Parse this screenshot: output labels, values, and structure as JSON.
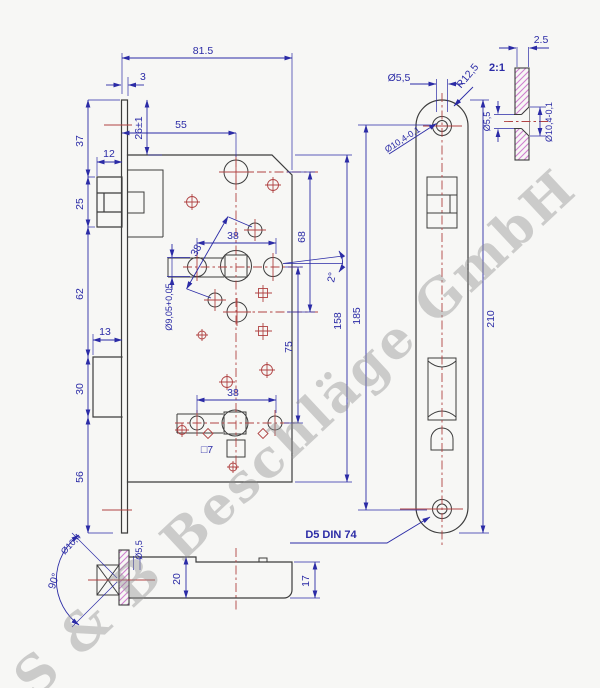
{
  "watermark": "S & B Beschläge GmbH",
  "notes": {
    "din": "D5 DIN 74",
    "detail_scale": "2:1"
  },
  "colors": {
    "outline": "#3c3c3c",
    "dimension": "#2b2ba6",
    "centerline": "#b04343",
    "hatch": "#cf7fcf",
    "watermark": "#8f8f8f"
  },
  "dims": {
    "overall_width": "81.5",
    "faceplate_offset": "3",
    "case_top_offset": "26±1",
    "backset": "55",
    "top_to_latch": "37",
    "latch_depth": "12",
    "latch_height": "25",
    "latch_to_bolt": "62",
    "bolt_depth": "13",
    "bolt_height": "30",
    "bolt_to_bottom": "56",
    "hole_pitch_upper": "38",
    "hole_pitch_diag": "38",
    "hole_pitch_lower": "38",
    "slot_dia": "Ø9,05+0,05",
    "hole_drop": "68",
    "tilt_angle": "2°",
    "follower_pitch": "75",
    "square_hole": "□7",
    "case_height": "158",
    "screw_pitch": "185",
    "plate_length": "210",
    "screw_dia": "Ø5,5",
    "plate_radius": "R12,5",
    "csk_dia_tol": "Ø10,4-0,1",
    "plate_thickness": "2.5",
    "det_screw_dia": "Ø5,5",
    "det_csk_dia": "Ø10,4-0,1",
    "csk_angle": "90°",
    "csk_dia": "Ø10,4",
    "csk_screw_dia": "Ø5,5",
    "case_depth_total": "20",
    "case_depth": "17"
  }
}
